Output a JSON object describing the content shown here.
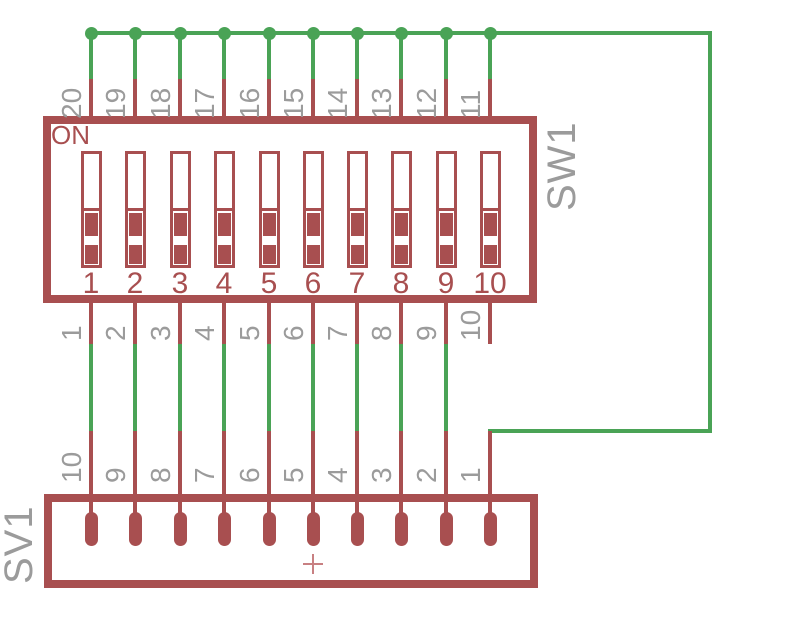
{
  "colors": {
    "background": "#ffffff",
    "net_green": "#4aa356",
    "symbol_red": "#a84f50",
    "label_gray": "#9b9b9b",
    "origin_cross": "#c88082"
  },
  "sw1": {
    "ref_label": "SW1",
    "on_label": "ON",
    "top_pin_labels": [
      "20",
      "19",
      "18",
      "17",
      "16",
      "15",
      "14",
      "13",
      "12",
      "11"
    ],
    "bottom_pin_labels": [
      "1",
      "2",
      "3",
      "4",
      "5",
      "6",
      "7",
      "8",
      "9",
      "10"
    ],
    "position_labels": [
      "1",
      "2",
      "3",
      "4",
      "5",
      "6",
      "7",
      "8",
      "9",
      "10"
    ]
  },
  "sv1": {
    "ref_label": "SV1",
    "pin_labels": [
      "10",
      "9",
      "8",
      "7",
      "6",
      "5",
      "4",
      "3",
      "2",
      "1"
    ]
  }
}
